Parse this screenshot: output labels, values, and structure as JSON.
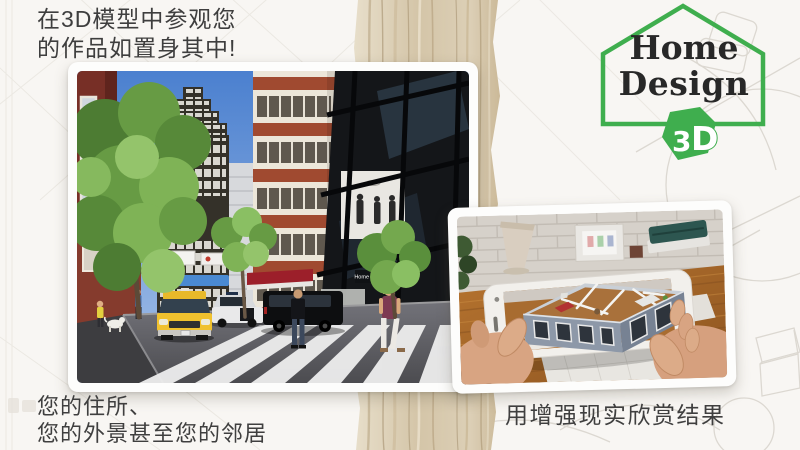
{
  "colors": {
    "background": "#f8f6f3",
    "accent_green": "#3fae4e",
    "headline_text": "#3e3e3e",
    "logo_text": "#282828",
    "wood_light": "#e4dac6",
    "wood_dark": "#b49a76"
  },
  "headline": {
    "line1": "在3D模型中参观您",
    "line2": "的作品如置身其中!"
  },
  "logo": {
    "word1": "Home",
    "word2": "Design",
    "badge_digit": "3",
    "badge_letter": "D"
  },
  "city_photo": {
    "alt": "3D render of a city street with skyscrapers, trees, yellow taxi, police car and pedestrians on a crosswalk",
    "storefront_sign": "Home Design",
    "caption_line1": "您的住所、",
    "caption_line2": "您的外景甚至您的邻居"
  },
  "ar_photo": {
    "alt": "Hands holding a phone showing an augmented-reality 3D floor plan over a desk",
    "caption": "用增强现实欣赏结果"
  }
}
